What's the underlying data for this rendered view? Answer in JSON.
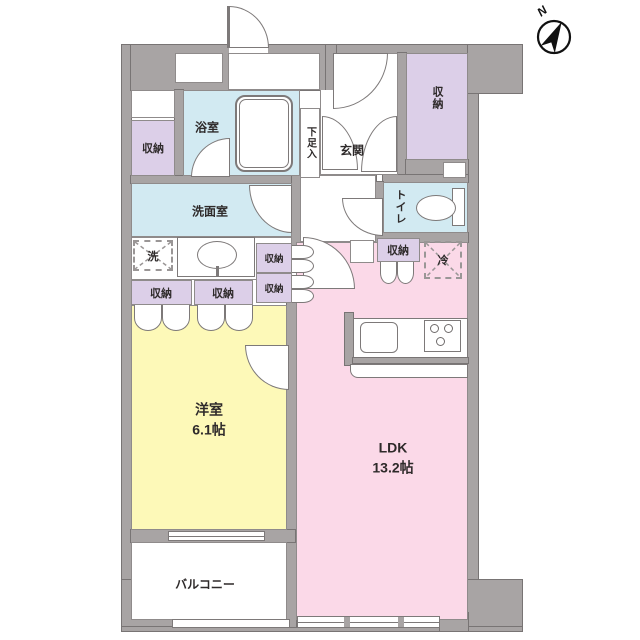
{
  "compass": {
    "north_label": "N"
  },
  "rooms": {
    "western_room": {
      "name": "洋室",
      "size": "6.1帖"
    },
    "ldk": {
      "name": "LDK",
      "size": "13.2帖"
    },
    "bathroom": {
      "label": "浴室"
    },
    "washroom": {
      "label": "洗面室"
    },
    "entrance": {
      "label": "玄関"
    },
    "shoe_storage": {
      "label": "下足入"
    },
    "toilet": {
      "label": "トイレ"
    },
    "balcony": {
      "label": "バルコニー"
    }
  },
  "fixtures": {
    "storage_label": "収納",
    "washer_label": "洗",
    "refrigerator_label": "冷"
  },
  "colors": {
    "wall": "#a8a4a4",
    "water_rooms": "#d2eaf2",
    "storage": "#dccfe8",
    "western_room": "#fdf9b8",
    "ldk": "#fbd9e8",
    "outline": "#7d7979"
  }
}
